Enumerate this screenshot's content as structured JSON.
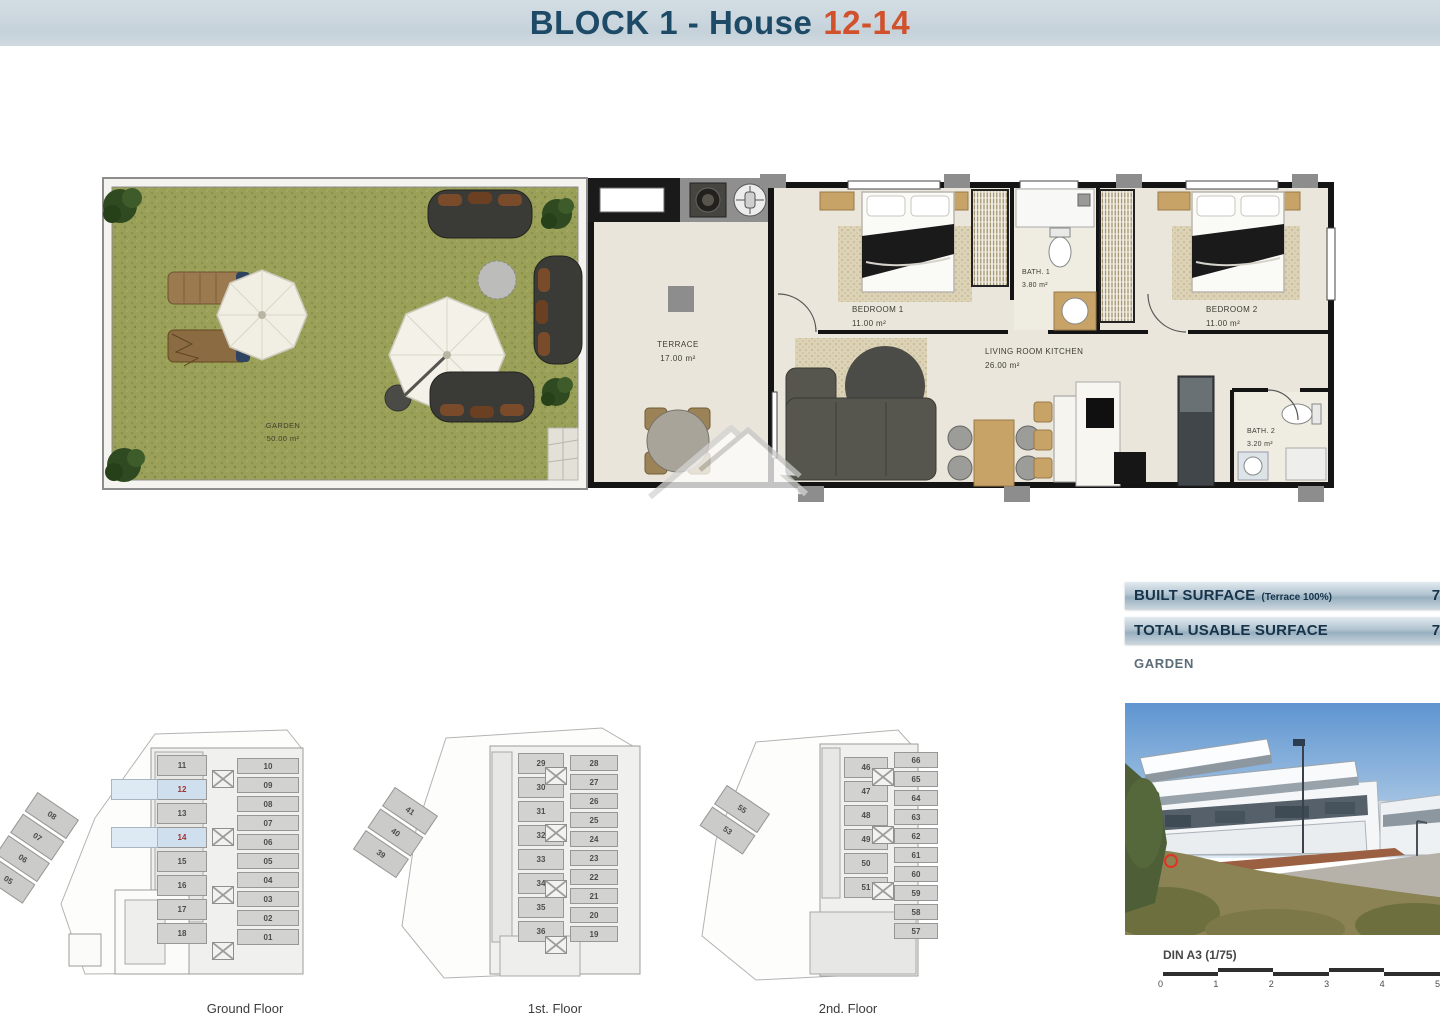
{
  "header": {
    "title_main": "BLOCK 1 - House",
    "title_number": "12-14"
  },
  "colors": {
    "title_navy": "#1d4a66",
    "accent_orange": "#d0512c",
    "table_navy": "#16334a",
    "highlight_blue": "#cfdfee",
    "unit_red": "#9e3430",
    "grass_green": "#9aa058",
    "wall_black": "#141414",
    "floor_beige": "#eae6db"
  },
  "plan": {
    "garden": {
      "label": "GARDEN",
      "area": "50.00 m²"
    },
    "terrace": {
      "label": "TERRACE",
      "area": "17.00 m²"
    },
    "bedroom1": {
      "label": "BEDROOM 1",
      "area": "11.00 m²"
    },
    "bath1": {
      "label": "BATH. 1",
      "area": "3.80 m²"
    },
    "living": {
      "label": "LIVING ROOM KITCHEN",
      "area": "26.00 m²"
    },
    "bedroom2": {
      "label": "BEDROOM 2",
      "area": "11.00 m²"
    },
    "bath2": {
      "label": "BATH. 2",
      "area": "3.20 m²"
    }
  },
  "surface_table": {
    "rows": [
      {
        "label": "BUILT SURFACE",
        "note": "(Terrace 100%)",
        "value": "78.3"
      },
      {
        "label": "TOTAL USABLE SURFACE",
        "note": "",
        "value": "72.0"
      },
      {
        "label": "GARDEN",
        "note": "",
        "value": "50."
      }
    ]
  },
  "floor_plans": {
    "ground": {
      "label": "Ground Floor",
      "center_units": [
        {
          "n": "11"
        },
        {
          "n": "12",
          "hl": true
        },
        {
          "n": "13"
        },
        {
          "n": "14",
          "hl": true
        },
        {
          "n": "15"
        },
        {
          "n": "16"
        },
        {
          "n": "17"
        },
        {
          "n": "18"
        }
      ],
      "right_units": [
        {
          "n": "10"
        },
        {
          "n": "09"
        },
        {
          "n": "08"
        },
        {
          "n": "07"
        },
        {
          "n": "06"
        },
        {
          "n": "05"
        },
        {
          "n": "04"
        },
        {
          "n": "03"
        },
        {
          "n": "02"
        },
        {
          "n": "01"
        }
      ],
      "wing_units": [
        {
          "n": "08"
        },
        {
          "n": "07"
        },
        {
          "n": "06"
        },
        {
          "n": "05"
        }
      ]
    },
    "first": {
      "label": "1st. Floor",
      "center_units": [
        {
          "n": "29"
        },
        {
          "n": "30"
        },
        {
          "n": "31"
        },
        {
          "n": "32"
        },
        {
          "n": "33"
        },
        {
          "n": "34"
        },
        {
          "n": "35"
        },
        {
          "n": "36"
        }
      ],
      "right_units": [
        {
          "n": "28"
        },
        {
          "n": "27"
        },
        {
          "n": "26"
        },
        {
          "n": "25"
        },
        {
          "n": "24"
        },
        {
          "n": "23"
        },
        {
          "n": "22"
        },
        {
          "n": "21"
        },
        {
          "n": "20"
        },
        {
          "n": "19"
        }
      ],
      "wing_units": [
        {
          "n": "41"
        },
        {
          "n": "40"
        },
        {
          "n": "39"
        }
      ]
    },
    "second": {
      "label": "2nd. Floor",
      "center_units": [
        {
          "n": "46"
        },
        {
          "n": "47"
        },
        {
          "n": "48"
        },
        {
          "n": "49"
        },
        {
          "n": "50"
        },
        {
          "n": "51"
        }
      ],
      "right_units": [
        {
          "n": "66"
        },
        {
          "n": "65"
        },
        {
          "n": "64"
        },
        {
          "n": "63"
        },
        {
          "n": "62"
        },
        {
          "n": "61"
        },
        {
          "n": "60"
        },
        {
          "n": "59"
        },
        {
          "n": "58"
        },
        {
          "n": "57"
        }
      ],
      "wing_units": [
        {
          "n": "55"
        },
        {
          "n": "53"
        }
      ]
    }
  },
  "scale_bar": {
    "label": "DIN A3 (1/75)",
    "ticks": [
      "0",
      "1",
      "2",
      "3",
      "4",
      "5"
    ]
  }
}
